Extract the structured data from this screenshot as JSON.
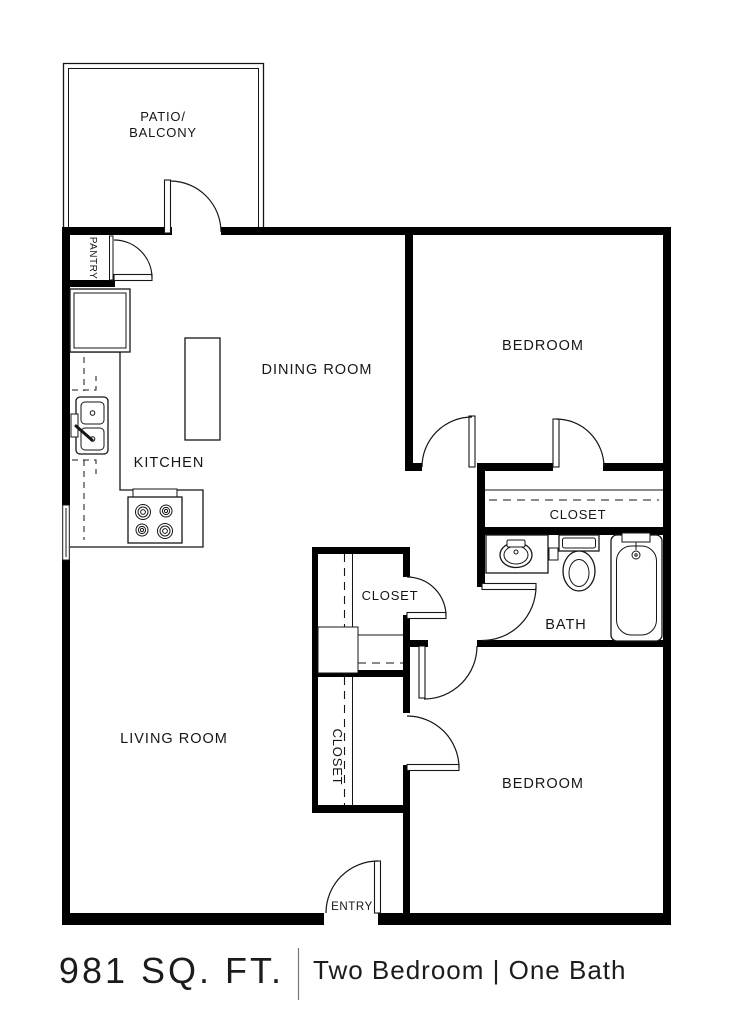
{
  "rooms": {
    "patio_line1": "PATIO/",
    "patio_line2": "BALCONY",
    "pantry": "PANTRY",
    "dining": "DINING ROOM",
    "kitchen": "KITCHEN",
    "bedroom_top": "BEDROOM",
    "closet_bedroom1": "CLOSET",
    "bath": "BATH",
    "closet_hall": "CLOSET",
    "closet_bedroom2": "CLOSET",
    "living": "LIVING ROOM",
    "bedroom_bottom": "BEDROOM",
    "entry": "ENTRY"
  },
  "footer": {
    "area": "981 SQ. FT.",
    "description": "Two Bedroom | One Bath"
  },
  "colors": {
    "wall": "#000000",
    "line": "#161616",
    "text": "#161616",
    "background": "#ffffff",
    "divider": "#777777"
  }
}
